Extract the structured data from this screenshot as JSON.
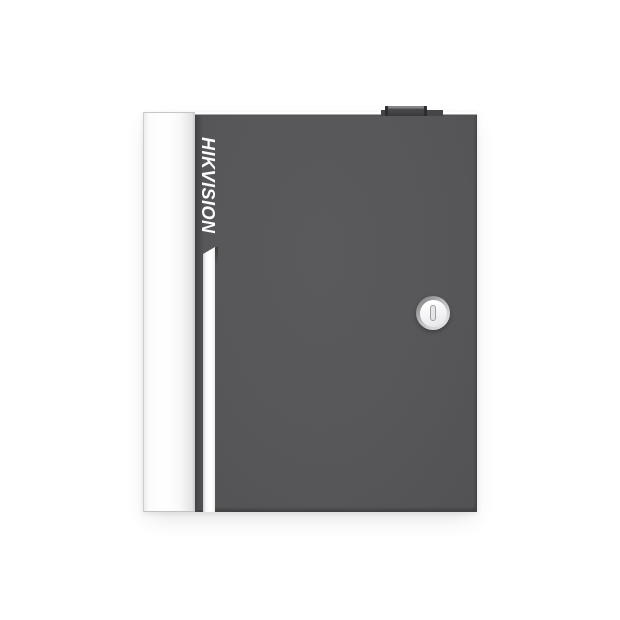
{
  "meta": {
    "domain": "natural-image",
    "alt": "Front view product photo of a dark gray metal access-controller enclosure with a white hinge-side panel, vertical brand logotype, white accent stripe, round cam lock and a small protrusion on top, on a white background"
  },
  "product": {
    "brand": "HIKVISION"
  },
  "colors": {
    "background": "#ffffff",
    "door_gray": "#575759",
    "door_bottom_edge": "#434345",
    "side_panel_white": "#fdfdfd",
    "panel_border": "#c6c6c6",
    "brand_text": "#fcfcfc",
    "accent_stripe": "#ffffff",
    "bump_dark": "#39393b",
    "bump_highlight": "#85858a",
    "lock_ring": "#a9a9ab",
    "lock_face": "#f5f5f6",
    "keyhole_outline": "#9e9ea1"
  }
}
